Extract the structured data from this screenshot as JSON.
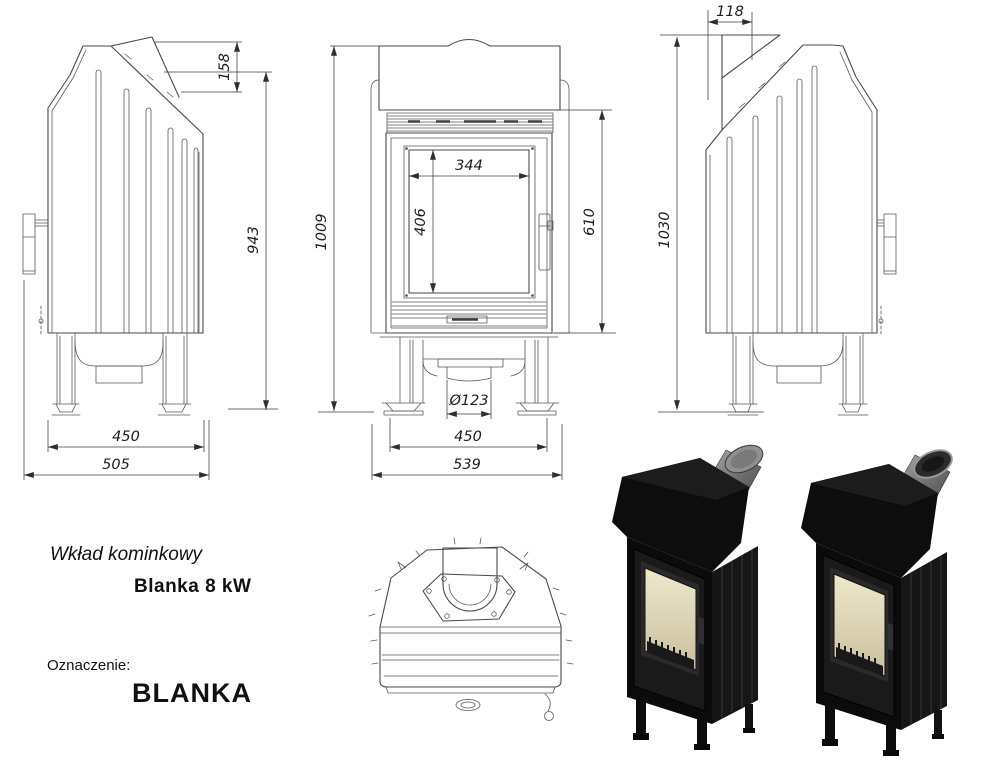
{
  "page": {
    "colors": {
      "background": "#ffffff",
      "drawing_line": "#4a4a4a",
      "dimension_line": "#3c3c3c",
      "dimension_text": "#1c1c1c",
      "render_body_black": "#101010",
      "render_glass_beige": "#e9e2c6",
      "render_pipe_gray": "#8f8f8f"
    }
  },
  "title_block": {
    "product_type": "Wkład kominkowy",
    "model_power": "Blanka 8 kW",
    "designation_label": "Oznaczenie:",
    "designation_value": "BLANKA"
  },
  "dimensions": {
    "left_view": {
      "stub_height": "158",
      "rear_height": "943",
      "feet_span": "450",
      "depth": "505"
    },
    "front_view": {
      "total_height": "1009",
      "glass_width": "344",
      "glass_height": "406",
      "door_height": "610",
      "flue_diameter": "Ø123",
      "leg_span": "450",
      "width": "539"
    },
    "right_view": {
      "flue_offset": "118",
      "total_height": "1030"
    }
  }
}
